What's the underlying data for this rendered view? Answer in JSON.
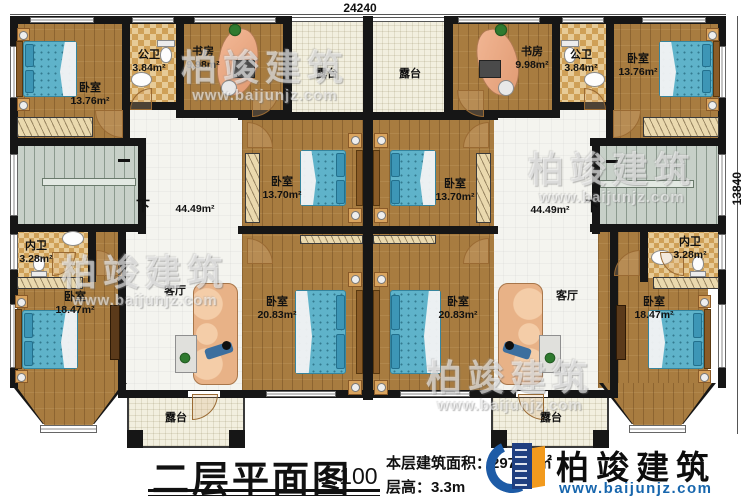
{
  "plan": {
    "dim_top": "24240",
    "dim_right": "13840",
    "down_label": "下",
    "rooms": {
      "bedroom_tl": {
        "name": "卧室",
        "area": "13.76m²"
      },
      "bath_public_left": {
        "name": "公卫",
        "area": "3.84m²"
      },
      "study_left": {
        "name": "书房",
        "area": "9.98m²"
      },
      "terrace_top_left": {
        "name": "露台"
      },
      "terrace_top_right": {
        "name": "露台"
      },
      "study_right": {
        "name": "书房",
        "area": "9.98m²"
      },
      "bath_public_right": {
        "name": "公卫",
        "area": "3.84m²"
      },
      "bedroom_tr": {
        "name": "卧室",
        "area": "13.76m²"
      },
      "bedroom_cl": {
        "name": "卧室",
        "area": "13.70m²"
      },
      "bedroom_cr": {
        "name": "卧室",
        "area": "13.70m²"
      },
      "hall_left": {
        "name": "客厅",
        "area": "44.49m²"
      },
      "hall_right": {
        "name": "客厅",
        "area": "44.49m²"
      },
      "bath_inner_left": {
        "name": "内卫",
        "area": "3.28m²"
      },
      "bath_inner_right": {
        "name": "内卫",
        "area": "3.28m²"
      },
      "bedroom_bl": {
        "name": "卧室",
        "area": "18.47m²"
      },
      "bedroom_bcl": {
        "name": "卧室",
        "area": "20.83m²"
      },
      "bedroom_bcr": {
        "name": "卧室",
        "area": "20.83m²"
      },
      "bedroom_br": {
        "name": "卧室",
        "area": "18.47m²"
      },
      "terrace_bottom_left": {
        "name": "露台"
      },
      "terrace_bottom_right": {
        "name": "露台"
      }
    }
  },
  "title_block": {
    "title": "二层平面图",
    "scale": "1:100",
    "area_label": "本层建筑面积：297.50㎡",
    "floor_height_label": "层高：3.3m"
  },
  "logo": {
    "name": "柏竣建筑",
    "website": "www.baijunjz.com"
  },
  "watermark": {
    "name": "柏竣建筑",
    "website": "www.baijunjz.com"
  },
  "colors": {
    "wall": "#161616",
    "wood_floor": "#a87c40",
    "bed_blue": "#5fb3ca",
    "checker_tan": "#cfa057",
    "logo_blue": "#1d5ba6",
    "logo_orange": "#f29a1d",
    "website_blue": "#1766ad"
  }
}
